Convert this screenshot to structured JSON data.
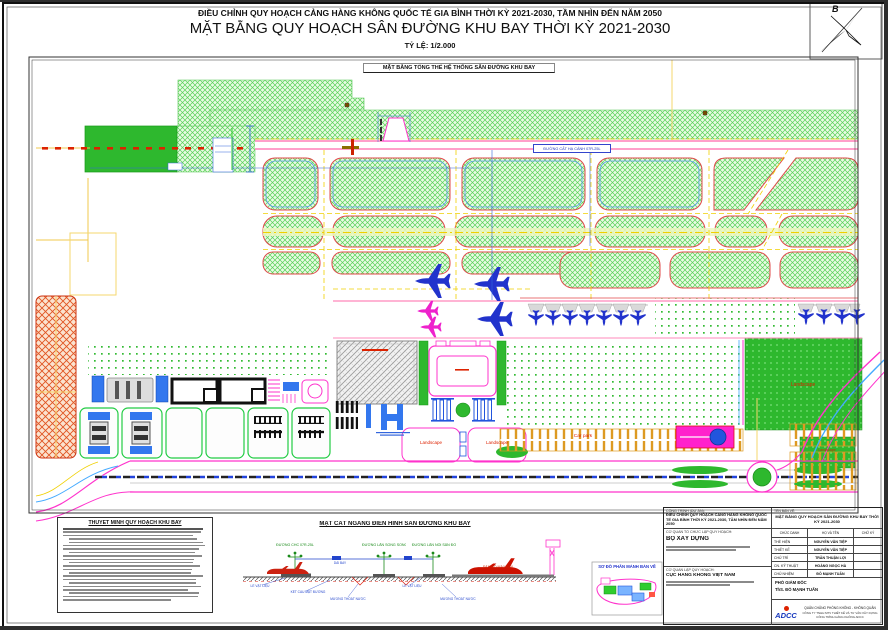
{
  "page": {
    "header_title": "ĐIỀU CHỈNH QUY HOẠCH CẢNG HÀNG KHÔNG QUỐC TẾ GIA BÌNH THỜI KỲ 2021-2030, TẦM NHÌN ĐẾN NĂM 2050",
    "drawing_title": "MẶT BẰNG QUY HOẠCH SÂN ĐƯỜNG KHU BAY THỜI KỲ 2021-2030",
    "scale_label": "TỶ LỆ: 1/2.000",
    "plan_subtitle": "MẶT BẰNG TỔNG THỂ HỆ THỐNG SÂN ĐƯỜNG KHU BAY",
    "north_label": "B"
  },
  "plan": {
    "runway_label": "ĐƯỜNG CẤT HẠ CÁNH 07R-25L",
    "landscape_label": "Landscape",
    "car_park_label": "Car park"
  },
  "legend": {
    "title": "THUYẾT MINH QUY HOẠCH KHU BAY"
  },
  "cross_section": {
    "title": "MẶT CẮT NGANG ĐIỂN HÌNH SÂN ĐƯỜNG KHU BAY",
    "runway_label": "ĐƯỜNG CHC 07R-25L",
    "parallel_taxiway_label": "ĐƯỜNG LĂN SONG SONG",
    "connector_taxiway_label": "ĐƯỜNG LĂN NỐI SÂN ĐỖ",
    "strip_label": "DẢI BAY",
    "apron_label": "SÂN ĐỖ MÁY BAY",
    "shoulder_label": "LỀ VẬT LIỆU",
    "pavement_label": "KẾT CẤU MẶT ĐƯỜNG",
    "ditch_label": "MƯƠNG THOÁT NƯỚC"
  },
  "key_map": {
    "title": "SƠ ĐỒ PHÂN MẢNH BẢN VẼ"
  },
  "title_block": {
    "project_label": "CÔNG TRÌNH (DỰ ÁN):",
    "project_name": "ĐIỀU CHỈNH QUY HOẠCH CẢNG HÀNG KHÔNG QUỐC TẾ GIA BÌNH THỜI KỲ 2021-2030, TẦM NHÌN ĐẾN NĂM 2050",
    "drawing_name_label": "TÊN BẢN VẼ:",
    "drawing_name": "MẶT BẰNG QUY HOẠCH SÂN ĐƯỜNG KHU BAY THỜI KỲ 2021-2030",
    "org_label": "CƠ QUAN TỔ CHỨC LẬP QUY HOẠCH:",
    "org_name": "BỘ XÂY DỰNG",
    "agency_label": "CƠ QUAN LẬP QUY HOẠCH:",
    "agency_name": "CỤC HÀNG KHÔNG VIỆT NAM",
    "table": {
      "headers": [
        "CHỨC DANH",
        "HỌ VÀ TÊN",
        "CHỮ KÝ"
      ],
      "rows": [
        [
          "THỂ HIỆN",
          "NGUYỄN VĂN TIỆP"
        ],
        [
          "THIẾT KẾ",
          "NGUYỄN VĂN TIỆP"
        ],
        [
          "CHỦ TRÌ",
          "TRẦN THUẬN LỢI"
        ],
        [
          "CN. KỸ THUẬT",
          "HOÀNG NGỌC HÀ"
        ],
        [
          "CHỦ NHIỆM",
          "ĐỖ MẠNH TUẤN"
        ]
      ]
    },
    "approver_title": "PHÓ GIÁM ĐỐC",
    "approver_name": "ThS. ĐỖ MẠNH TUẤN",
    "company_logo": "ADCC",
    "company_line1": "QUÂN CHỦNG PHÒNG KHÔNG - KHÔNG QUÂN",
    "company_line2": "CÔNG TY TNHH MTV THIẾT KẾ VÀ TƯ VẤN XÂY DỰNG CÔNG TRÌNH HÀNG KHÔNG ADCC"
  },
  "colors": {
    "marking_yellow": "#f0d000",
    "island_fill": "#eafbe4",
    "runway_edge": "#ff66aa",
    "road_edge": "#ff33cc",
    "aircraft_blue": "#2233cc",
    "aircraft_magenta": "#ee22cc",
    "grass_green": "#2eb82e",
    "military_zone": "#e05522",
    "dimension_blue": "#3366dd",
    "label_red": "#dd2200"
  }
}
